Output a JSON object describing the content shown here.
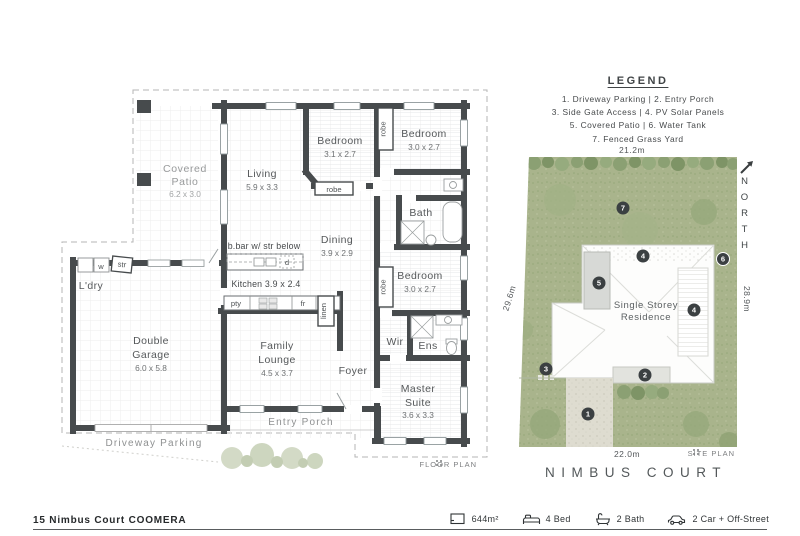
{
  "colors": {
    "wall": "#474b4d",
    "grass": "#a9b48c",
    "hedge": "#859a6b",
    "marker": "#3b4042",
    "driveway": "#dedcd0",
    "patio_slab": "#d7d9d6"
  },
  "legend": {
    "title": "LEGEND",
    "rows": [
      "1. Driveway Parking  |  2. Entry Porch",
      "3. Side Gate Access  |  4. PV Solar Panels",
      "5. Covered Patio  |  6. Water Tank",
      "7. Fenced Grass Yard"
    ]
  },
  "floor_plan": {
    "plan_label": "FLOOR PLAN",
    "covered_patio_1": "Covered",
    "covered_patio_2": "Patio",
    "covered_patio_d": "6.2 x 3.0",
    "living": "Living",
    "living_d": "5.9 x 3.3",
    "bedroom2": "Bedroom",
    "bedroom2_d": "3.1 x 2.7",
    "bedroom3": "Bedroom",
    "bedroom3_d": "3.0 x 2.7",
    "bath": "Bath",
    "dining": "Dining",
    "dining_d": "3.9 x 2.9",
    "bedroom4": "Bedroom",
    "bedroom4_d": "3.0 x 2.7",
    "bbar": "b.bar w/ str below",
    "kitchen": "Kitchen 3.9 x 2.4",
    "ldry": "L'dry",
    "garage_1": "Double",
    "garage_2": "Garage",
    "garage_d": "6.0 x 5.8",
    "family_1": "Family",
    "family_2": "Lounge",
    "family_d": "4.5 x 3.7",
    "foyer": "Foyer",
    "wir": "Wir",
    "ens": "Ens",
    "master_1": "Master",
    "master_2": "Suite",
    "master_d": "3.6 x 3.3",
    "entry_porch": "Entry Porch",
    "driveway": "Driveway Parking",
    "robe": "robe",
    "pty": "pty",
    "fr": "fr",
    "d": "d",
    "linen": "linen",
    "w": "w",
    "str": "str"
  },
  "site_plan": {
    "label": "SITE PLAN",
    "street": "NIMBUS COURT",
    "north": "NORTH",
    "residence_1": "Single Storey",
    "residence_2": "Residence",
    "dim_top": "21.2m",
    "dim_left": "29.6m",
    "dim_right": "28.9m",
    "dim_bottom": "22.0m",
    "markers": [
      "1",
      "2",
      "3",
      "4",
      "5",
      "6",
      "7"
    ]
  },
  "footer": {
    "address": "15 Nimbus Court COOMERA",
    "stats": [
      {
        "icon": "land-area-icon",
        "label": "644m²"
      },
      {
        "icon": "bed-icon",
        "label": "4 Bed"
      },
      {
        "icon": "bath-icon",
        "label": "2 Bath"
      },
      {
        "icon": "car-icon",
        "label": "2 Car + Off-Street"
      }
    ]
  }
}
